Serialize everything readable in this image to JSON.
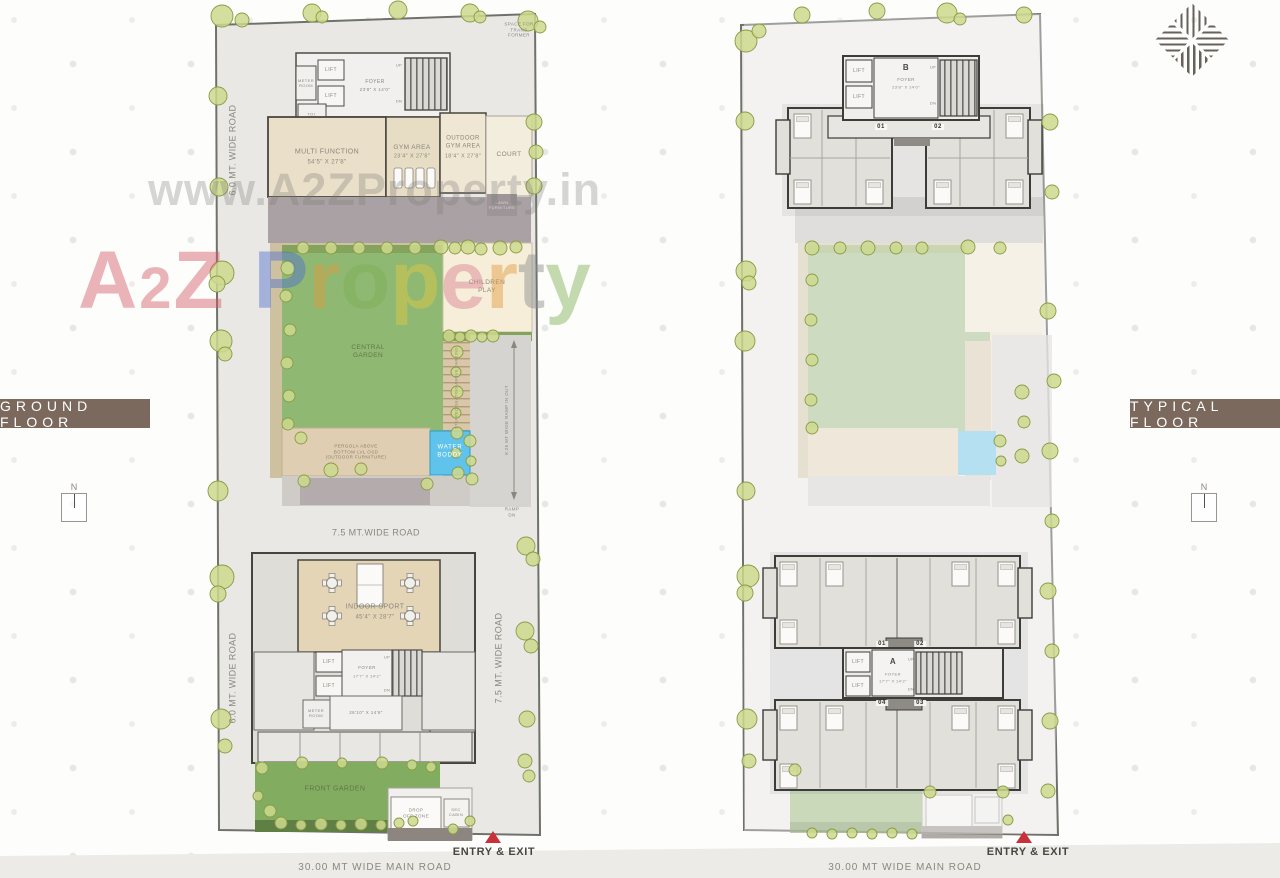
{
  "watermark": {
    "url": "www.A2ZProperty.in",
    "brand": [
      {
        "ch": "A",
        "color": "#d15a64"
      },
      {
        "ch": "2",
        "color": "#d15a64",
        "small": true
      },
      {
        "ch": "Z",
        "color": "#d15a64"
      },
      {
        "ch": "P",
        "color": "#4f6fd0",
        "gap": true
      },
      {
        "ch": "r",
        "color": "#e09a3c"
      },
      {
        "ch": "o",
        "color": "#7fb052"
      },
      {
        "ch": "p",
        "color": "#e5c83f"
      },
      {
        "ch": "e",
        "color": "#d97f93"
      },
      {
        "ch": "r",
        "color": "#e09a3c"
      },
      {
        "ch": "t",
        "color": "#8a8a8a"
      },
      {
        "ch": "y",
        "color": "#7fb052"
      }
    ]
  },
  "colors": {
    "badge_brown": "#7a695c",
    "entry_arrow_red": "#c9303a",
    "water_blue": "#5fc3ec",
    "garden_green": "#8fb873",
    "plot_gray": "#e9e8e5",
    "building_tan": "#e4d5b6"
  },
  "left": {
    "badge": "GROUND FLOOR",
    "north": "N",
    "entry_exit": "ENTRY & EXIT",
    "roads": {
      "top_left": "6.0 MT. WIDE ROAD",
      "bottom_left": "6.0 MT. WIDE ROAD",
      "mid": "7.5 MT.WIDE ROAD",
      "right_vert": "7.5 MT. WIDE ROAD",
      "main": "30.00 MT WIDE MAIN ROAD"
    },
    "notes": {
      "transformer": "SPACE FOR\nTRANS\nFORMER",
      "ramp_side": "8.25 MT WIDE RAMP IN OUT",
      "ramp_dn": "RAMP\nDN",
      "seating": "STEPPED SEATING\nABOVE PARKING",
      "furniture": "LAWN\nFURNITURE",
      "pergola": "PERGOLA ABOVE\nBOTTOM LVL OSD\n(OUTDOOR FURNITURE)"
    },
    "club": {
      "lift": "LIFT",
      "meter": "METER\nROOM",
      "toi": "TOI.",
      "foyer": "FOYER",
      "foyer_dim": "23'8\" X 14'0\"",
      "up": "UP",
      "dn": "DN",
      "rooms": [
        {
          "name": "MULTI FUNCTION",
          "dim": "54'5\" X 27'8\""
        },
        {
          "name": "GYM AREA",
          "dim": "23'4\" X 27'8\""
        },
        {
          "name": "OUTDOOR\nGYM AREA",
          "dim": "18'4\" X 27'8\""
        },
        {
          "name": "COURT",
          "dim": ""
        }
      ]
    },
    "amen": {
      "central": "CENTRAL\nGARDEN",
      "children": "CHILDREN\nPLAY",
      "water": "WATER\nBODDY",
      "front": "FRONT GARDEN"
    },
    "lower": {
      "name": "INDOOR SPORT",
      "dim": "45'4\" X 28'7\"",
      "lift": "LIFT",
      "foyer": "FOYER",
      "foyer_dim": "17'7\" X 14'2\"",
      "up": "UP",
      "dn": "DN",
      "meter": "METER\nROOM",
      "hall_dim": "26'10\" X 14'6\"",
      "drop": "DROP\nOFF ZONE",
      "sec": "SEC\nCABIN"
    }
  },
  "right": {
    "badge": "TYPICAL FLOOR",
    "north": "N",
    "entry_exit": "ENTRY & EXIT",
    "main_road": "30.00 MT WIDE MAIN ROAD",
    "tower_b": {
      "label": "B",
      "foyer": "FOYER",
      "foyer_dim": "23'8\" X 14'0\"",
      "lift": "LIFT",
      "up": "UP",
      "dn": "DN",
      "units": [
        "01",
        "02"
      ]
    },
    "tower_a": {
      "label": "A",
      "foyer": "FOYER",
      "foyer_dim": "17'7\" X 14'2\"",
      "lift": "LIFT",
      "up": "UP",
      "dn": "DN",
      "units": [
        "01",
        "02",
        "04",
        "03"
      ]
    }
  }
}
